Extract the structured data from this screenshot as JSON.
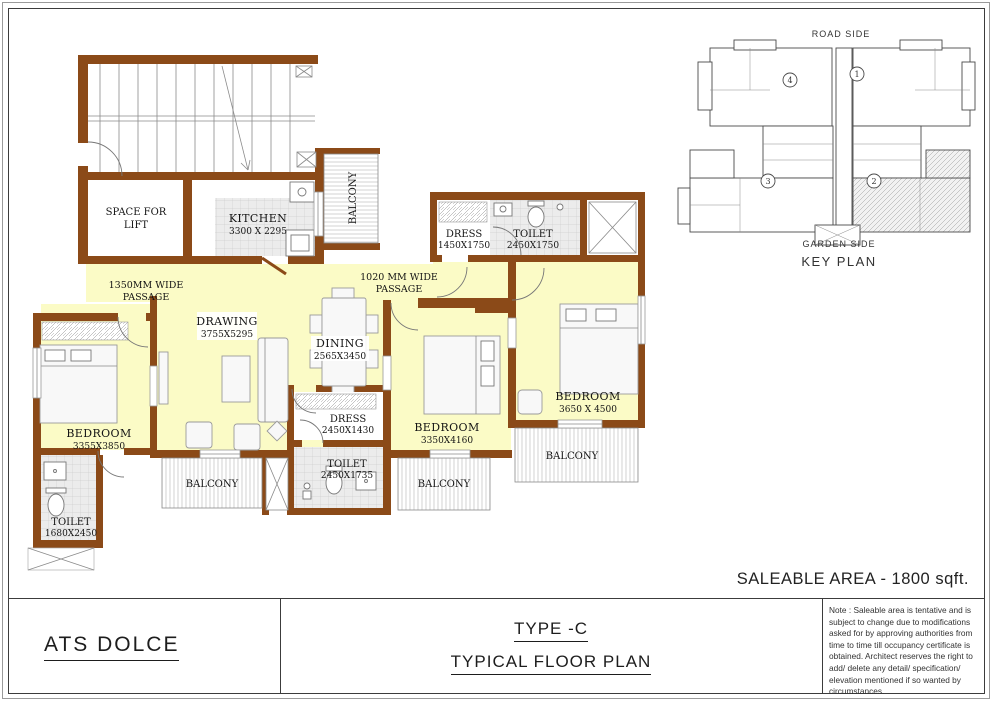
{
  "colors": {
    "wall": "#8B4A18",
    "room_fill": "#FBFBC6",
    "tile": "#ececec",
    "page_border": "#3c3c3c"
  },
  "plan": {
    "lift": {
      "line1": "SPACE FOR",
      "line2": "LIFT"
    },
    "kitchen": {
      "name": "KITCHEN",
      "dims": "3300 X 2295"
    },
    "balcony_top": {
      "name": "BALCONY"
    },
    "dress1": {
      "name": "DRESS",
      "dims": "1450X1750"
    },
    "toilet1": {
      "name": "TOILET",
      "dims": "2450X1750"
    },
    "passage1": {
      "line1": "1350MM WIDE",
      "line2": "PASSAGE"
    },
    "passage2": {
      "line1": "1020 MM WIDE",
      "line2": "PASSAGE"
    },
    "drawing": {
      "name": "DRAWING",
      "dims": "3755X5295"
    },
    "dining": {
      "name": "DINING",
      "dims": "2565X3450"
    },
    "bedroom1": {
      "name": "BEDROOM",
      "dims": "3355X3850"
    },
    "bedroom2": {
      "name": "BEDROOM",
      "dims": "3350X4160"
    },
    "bedroom3": {
      "name": "BEDROOM",
      "dims": "3650 X 4500"
    },
    "dress2": {
      "name": "DRESS",
      "dims": "2450X1430"
    },
    "toilet2": {
      "name": "TOILET",
      "dims": "2450X1735"
    },
    "toilet3": {
      "name": "TOILET",
      "dims": "1680X2450"
    },
    "balcony_left": {
      "name": "BALCONY"
    },
    "balcony_mid": {
      "name": "BALCONY"
    },
    "balcony_right": {
      "name": "BALCONY"
    }
  },
  "key_plan": {
    "road_side": "ROAD SIDE",
    "garden_side": "GARDEN SIDE",
    "title": "KEY PLAN",
    "unit1": "1",
    "unit2": "2",
    "unit3": "3",
    "unit4": "4"
  },
  "footer": {
    "project": "ATS DOLCE",
    "type_label": "TYPE -C",
    "plan_label": "TYPICAL FLOOR PLAN",
    "saleable_area": "SALEABLE AREA - 1800 sqft.",
    "note": "Note : Saleable area is tentative and is subject to change due to modifications asked for by approving authorities from time to time till occupancy certificate is obtained. Architect reserves the right to add/ delete any detail/ specification/ elevation mentioned if so wanted by circumstances."
  }
}
